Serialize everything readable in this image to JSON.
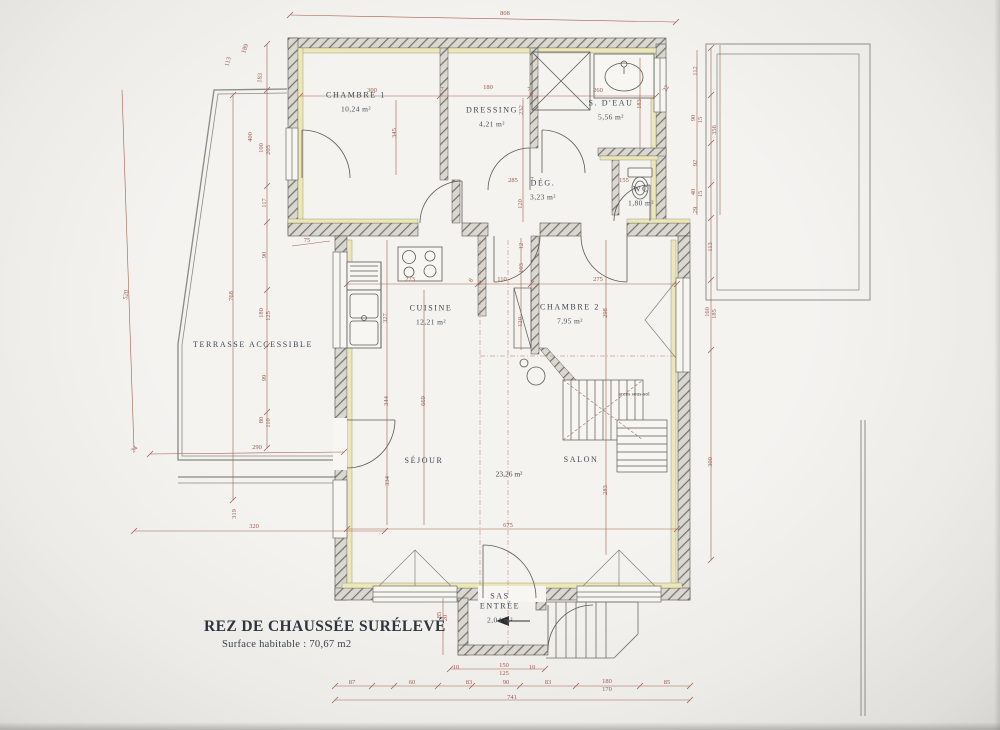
{
  "title_block": {
    "title": "REZ DE CHAUSSÉE SURÉLEVÉ",
    "subtitle": "Surface habitable : 70,67 m2"
  },
  "colors": {
    "paper": "#f3f2ef",
    "wall_hatch": "#6f6e64",
    "insulation": "#ece7b9",
    "dimension": "#9e5a4b",
    "ink": "#3f4552"
  },
  "rooms": [
    {
      "id": "chambre-1",
      "name": "CHAMBRE 1",
      "area": "10,24 m²",
      "x": 356,
      "y": 102,
      "nowrap": true
    },
    {
      "id": "dressing",
      "name": "DRESSING",
      "area": "4,21 m²",
      "x": 492,
      "y": 117,
      "nowrap": true
    },
    {
      "id": "salle-deau",
      "name": "S. D'EAU",
      "area": "5,56 m²",
      "x": 611,
      "y": 110,
      "nowrap": true
    },
    {
      "id": "degagement",
      "name": "DÉG.",
      "area": "3,23 m²",
      "x": 543,
      "y": 190,
      "nowrap": true
    },
    {
      "id": "wc",
      "name": "WC",
      "area": "1,80 m²",
      "x": 641,
      "y": 196,
      "nowrap": true
    },
    {
      "id": "cuisine",
      "name": "CUISINE",
      "area": "12,21 m²",
      "x": 431,
      "y": 315,
      "nowrap": true
    },
    {
      "id": "chambre-2",
      "name": "CHAMBRE 2",
      "area": "7,95 m²",
      "x": 570,
      "y": 314,
      "nowrap": true
    },
    {
      "id": "sejour",
      "name": "SÉJOUR",
      "area": "",
      "x": 424,
      "y": 461,
      "nowrap": true
    },
    {
      "id": "salon",
      "name": "SALON",
      "area": "",
      "x": 581,
      "y": 460,
      "nowrap": true
    },
    {
      "id": "terrasse",
      "name": "TERRASSE ACCESSIBLE",
      "area": "",
      "x": 253,
      "y": 345,
      "nowrap": true
    },
    {
      "id": "sas-entree",
      "name": "SAS ENTRÉE",
      "area": "2,04 m²",
      "x": 500,
      "y": 608,
      "w": 44
    }
  ],
  "annotations": [
    {
      "id": "living-area",
      "text": "23,26 m²",
      "x": 509,
      "y": 474,
      "size": 7.5
    },
    {
      "id": "stair-note",
      "text": "accès sous-sol",
      "x": 634,
      "y": 395,
      "size": 5.5
    }
  ],
  "dimensions": [
    {
      "v": "808",
      "x": 505,
      "y": 14,
      "r": 0
    },
    {
      "v": "520",
      "x": 127,
      "y": 295,
      "r": -81
    },
    {
      "v": "113",
      "x": 229,
      "y": 62,
      "r": -75
    },
    {
      "v": "189",
      "x": 246,
      "y": 49,
      "r": -70
    },
    {
      "v": "183",
      "x": 261,
      "y": 78,
      "r": -85
    },
    {
      "v": "400",
      "x": 251,
      "y": 137,
      "r": -90
    },
    {
      "v": "100",
      "x": 262,
      "y": 148,
      "r": -90
    },
    {
      "v": "203",
      "x": 269,
      "y": 150,
      "r": -90
    },
    {
      "v": "117",
      "x": 265,
      "y": 203,
      "r": -90
    },
    {
      "v": "90",
      "x": 265,
      "y": 255,
      "r": -90
    },
    {
      "v": "180",
      "x": 262,
      "y": 313,
      "r": -90
    },
    {
      "v": "125",
      "x": 269,
      "y": 316,
      "r": -90
    },
    {
      "v": "99",
      "x": 265,
      "y": 378,
      "r": -90
    },
    {
      "v": "80",
      "x": 262,
      "y": 420,
      "r": -90
    },
    {
      "v": "110",
      "x": 269,
      "y": 423,
      "r": -90
    },
    {
      "v": "768",
      "x": 232,
      "y": 296,
      "r": -90
    },
    {
      "v": "75",
      "x": 307,
      "y": 241,
      "r": 0
    },
    {
      "v": "290",
      "x": 257,
      "y": 448,
      "r": 0
    },
    {
      "v": "24",
      "x": 135,
      "y": 450,
      "r": -50
    },
    {
      "v": "319",
      "x": 235,
      "y": 514,
      "r": -90
    },
    {
      "v": "320",
      "x": 254,
      "y": 527,
      "r": 0
    },
    {
      "v": "300",
      "x": 372,
      "y": 91,
      "r": 0
    },
    {
      "v": "7",
      "x": 442,
      "y": 90,
      "r": 0
    },
    {
      "v": "180",
      "x": 488,
      "y": 88,
      "r": 0
    },
    {
      "v": "7",
      "x": 529,
      "y": 90,
      "r": 0
    },
    {
      "v": "260",
      "x": 598,
      "y": 91,
      "r": 0
    },
    {
      "v": "22",
      "x": 667,
      "y": 89,
      "r": -60
    },
    {
      "v": "345",
      "x": 395,
      "y": 133,
      "r": -90
    },
    {
      "v": "232",
      "x": 522,
      "y": 110,
      "r": -90
    },
    {
      "v": "183",
      "x": 640,
      "y": 104,
      "r": -90
    },
    {
      "v": "285",
      "x": 513,
      "y": 181,
      "r": 0
    },
    {
      "v": "7",
      "x": 532,
      "y": 180,
      "r": 0
    },
    {
      "v": "155",
      "x": 624,
      "y": 181,
      "r": 0
    },
    {
      "v": "120",
      "x": 521,
      "y": 204,
      "r": -90
    },
    {
      "v": "112",
      "x": 696,
      "y": 71,
      "r": -90
    },
    {
      "v": "90",
      "x": 694,
      "y": 118,
      "r": -90
    },
    {
      "v": "15",
      "x": 701,
      "y": 120,
      "r": -90
    },
    {
      "v": "92",
      "x": 696,
      "y": 163,
      "r": -90
    },
    {
      "v": "40",
      "x": 694,
      "y": 192,
      "r": -90
    },
    {
      "v": "15",
      "x": 701,
      "y": 194,
      "r": -90
    },
    {
      "v": "29",
      "x": 696,
      "y": 210,
      "r": -90
    },
    {
      "v": "356",
      "x": 715,
      "y": 130,
      "r": -90
    },
    {
      "v": "113",
      "x": 711,
      "y": 247,
      "r": -90
    },
    {
      "v": "160",
      "x": 708,
      "y": 312,
      "r": -90
    },
    {
      "v": "185",
      "x": 715,
      "y": 314,
      "r": -90
    },
    {
      "v": "300",
      "x": 711,
      "y": 462,
      "r": -90
    },
    {
      "v": "273",
      "x": 410,
      "y": 280,
      "r": 0
    },
    {
      "v": "8",
      "x": 472,
      "y": 281,
      "r": -55
    },
    {
      "v": "110",
      "x": 502,
      "y": 280,
      "r": 0
    },
    {
      "v": "275",
      "x": 598,
      "y": 280,
      "r": 0
    },
    {
      "v": "327",
      "x": 386,
      "y": 318,
      "r": -90
    },
    {
      "v": "12",
      "x": 522,
      "y": 246,
      "r": -90
    },
    {
      "v": "103",
      "x": 522,
      "y": 268,
      "r": -90
    },
    {
      "v": "120",
      "x": 521,
      "y": 322,
      "r": -90
    },
    {
      "v": "298",
      "x": 606,
      "y": 313,
      "r": -90
    },
    {
      "v": "669",
      "x": 424,
      "y": 401,
      "r": -90
    },
    {
      "v": "344",
      "x": 387,
      "y": 401,
      "r": -90
    },
    {
      "v": "334",
      "x": 388,
      "y": 481,
      "r": -90
    },
    {
      "v": "283",
      "x": 606,
      "y": 490,
      "r": -90
    },
    {
      "v": "675",
      "x": 508,
      "y": 526,
      "r": 0
    },
    {
      "v": "85",
      "x": 440,
      "y": 615,
      "r": -90
    },
    {
      "v": "20",
      "x": 446,
      "y": 618,
      "r": -90
    },
    {
      "v": "10",
      "x": 456,
      "y": 668,
      "r": 0
    },
    {
      "v": "150",
      "x": 504,
      "y": 666,
      "r": 0
    },
    {
      "v": "125",
      "x": 504,
      "y": 674,
      "r": 0
    },
    {
      "v": "10",
      "x": 532,
      "y": 668,
      "r": 0
    },
    {
      "v": "87",
      "x": 352,
      "y": 683,
      "r": 0
    },
    {
      "v": "60",
      "x": 412,
      "y": 683,
      "r": 0
    },
    {
      "v": "83",
      "x": 469,
      "y": 683,
      "r": 0
    },
    {
      "v": "90",
      "x": 506,
      "y": 683,
      "r": 0
    },
    {
      "v": "83",
      "x": 548,
      "y": 683,
      "r": 0
    },
    {
      "v": "180",
      "x": 607,
      "y": 682,
      "r": 0
    },
    {
      "v": "170",
      "x": 607,
      "y": 690,
      "r": 0
    },
    {
      "v": "85",
      "x": 667,
      "y": 683,
      "r": 0
    },
    {
      "v": "741",
      "x": 512,
      "y": 698,
      "r": 0
    }
  ]
}
